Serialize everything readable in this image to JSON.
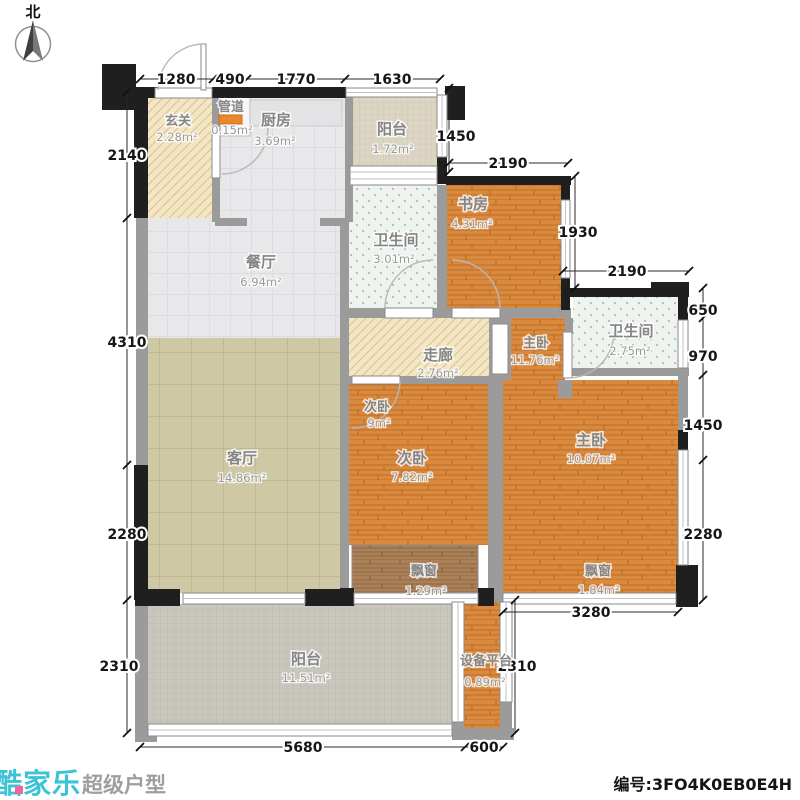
{
  "north": {
    "label": "北"
  },
  "rooms": {
    "entry": {
      "name": "玄关",
      "area": "2.28m²"
    },
    "duct": {
      "name": "管道",
      "area": "0.15m²"
    },
    "kitchen": {
      "name": "厨房",
      "area": "3.69m²"
    },
    "balcony_top": {
      "name": "阳台",
      "area": "1.72m²"
    },
    "bath1": {
      "name": "卫生间",
      "area": "3.01m²"
    },
    "study": {
      "name": "书房",
      "area": "4.31m²"
    },
    "dining": {
      "name": "餐厅",
      "area": "6.94m²"
    },
    "corridor": {
      "name": "走廊",
      "area": "2.76m²"
    },
    "master_foyer": {
      "name": "主卧",
      "area": "11.76m²"
    },
    "bath2": {
      "name": "卫生间",
      "area": "2.75m²"
    },
    "living": {
      "name": "客厅",
      "area": "14.86m²"
    },
    "bedroom2_label2": {
      "name": "次卧",
      "area": "9m²"
    },
    "bedroom2": {
      "name": "次卧",
      "area": "7.82m²"
    },
    "master": {
      "name": "主卧",
      "area": "10.07m²"
    },
    "bay_window_left": {
      "name": "飘窗",
      "area": "1.29m²"
    },
    "bay_window_right": {
      "name": "飘窗",
      "area": "1.84m²"
    },
    "balcony_bottom": {
      "name": "阳台",
      "area": "11.51m²"
    },
    "equipment_platform": {
      "name": "设备平台",
      "area": "0.89m²"
    }
  },
  "dimensions": {
    "top": [
      "1280",
      "490",
      "1770",
      "1630"
    ],
    "left": [
      "2140",
      "4310",
      "2280",
      "2310"
    ],
    "right": [
      "650",
      "970",
      "1450",
      "2280"
    ],
    "inner": {
      "balcony_top_height": "1450",
      "study_width": "2190",
      "study_height": "1930",
      "bath2_width": "2190",
      "master_bay_width": "3280",
      "equipment_height": "2310",
      "balcony_bottom_width": "5680",
      "equipment_width": "600"
    }
  },
  "footer": {
    "brand": "酷家乐",
    "tagline": "超级户型",
    "serial": "编号:3FO4K0EB0E4H"
  },
  "colors": {
    "wood": "#d98a3e",
    "duct_orange": "#e8882b",
    "brand_cyan": "#3cc3d6",
    "wall_dark": "#1f1f1f",
    "wall_gray": "#9b9b9b"
  }
}
